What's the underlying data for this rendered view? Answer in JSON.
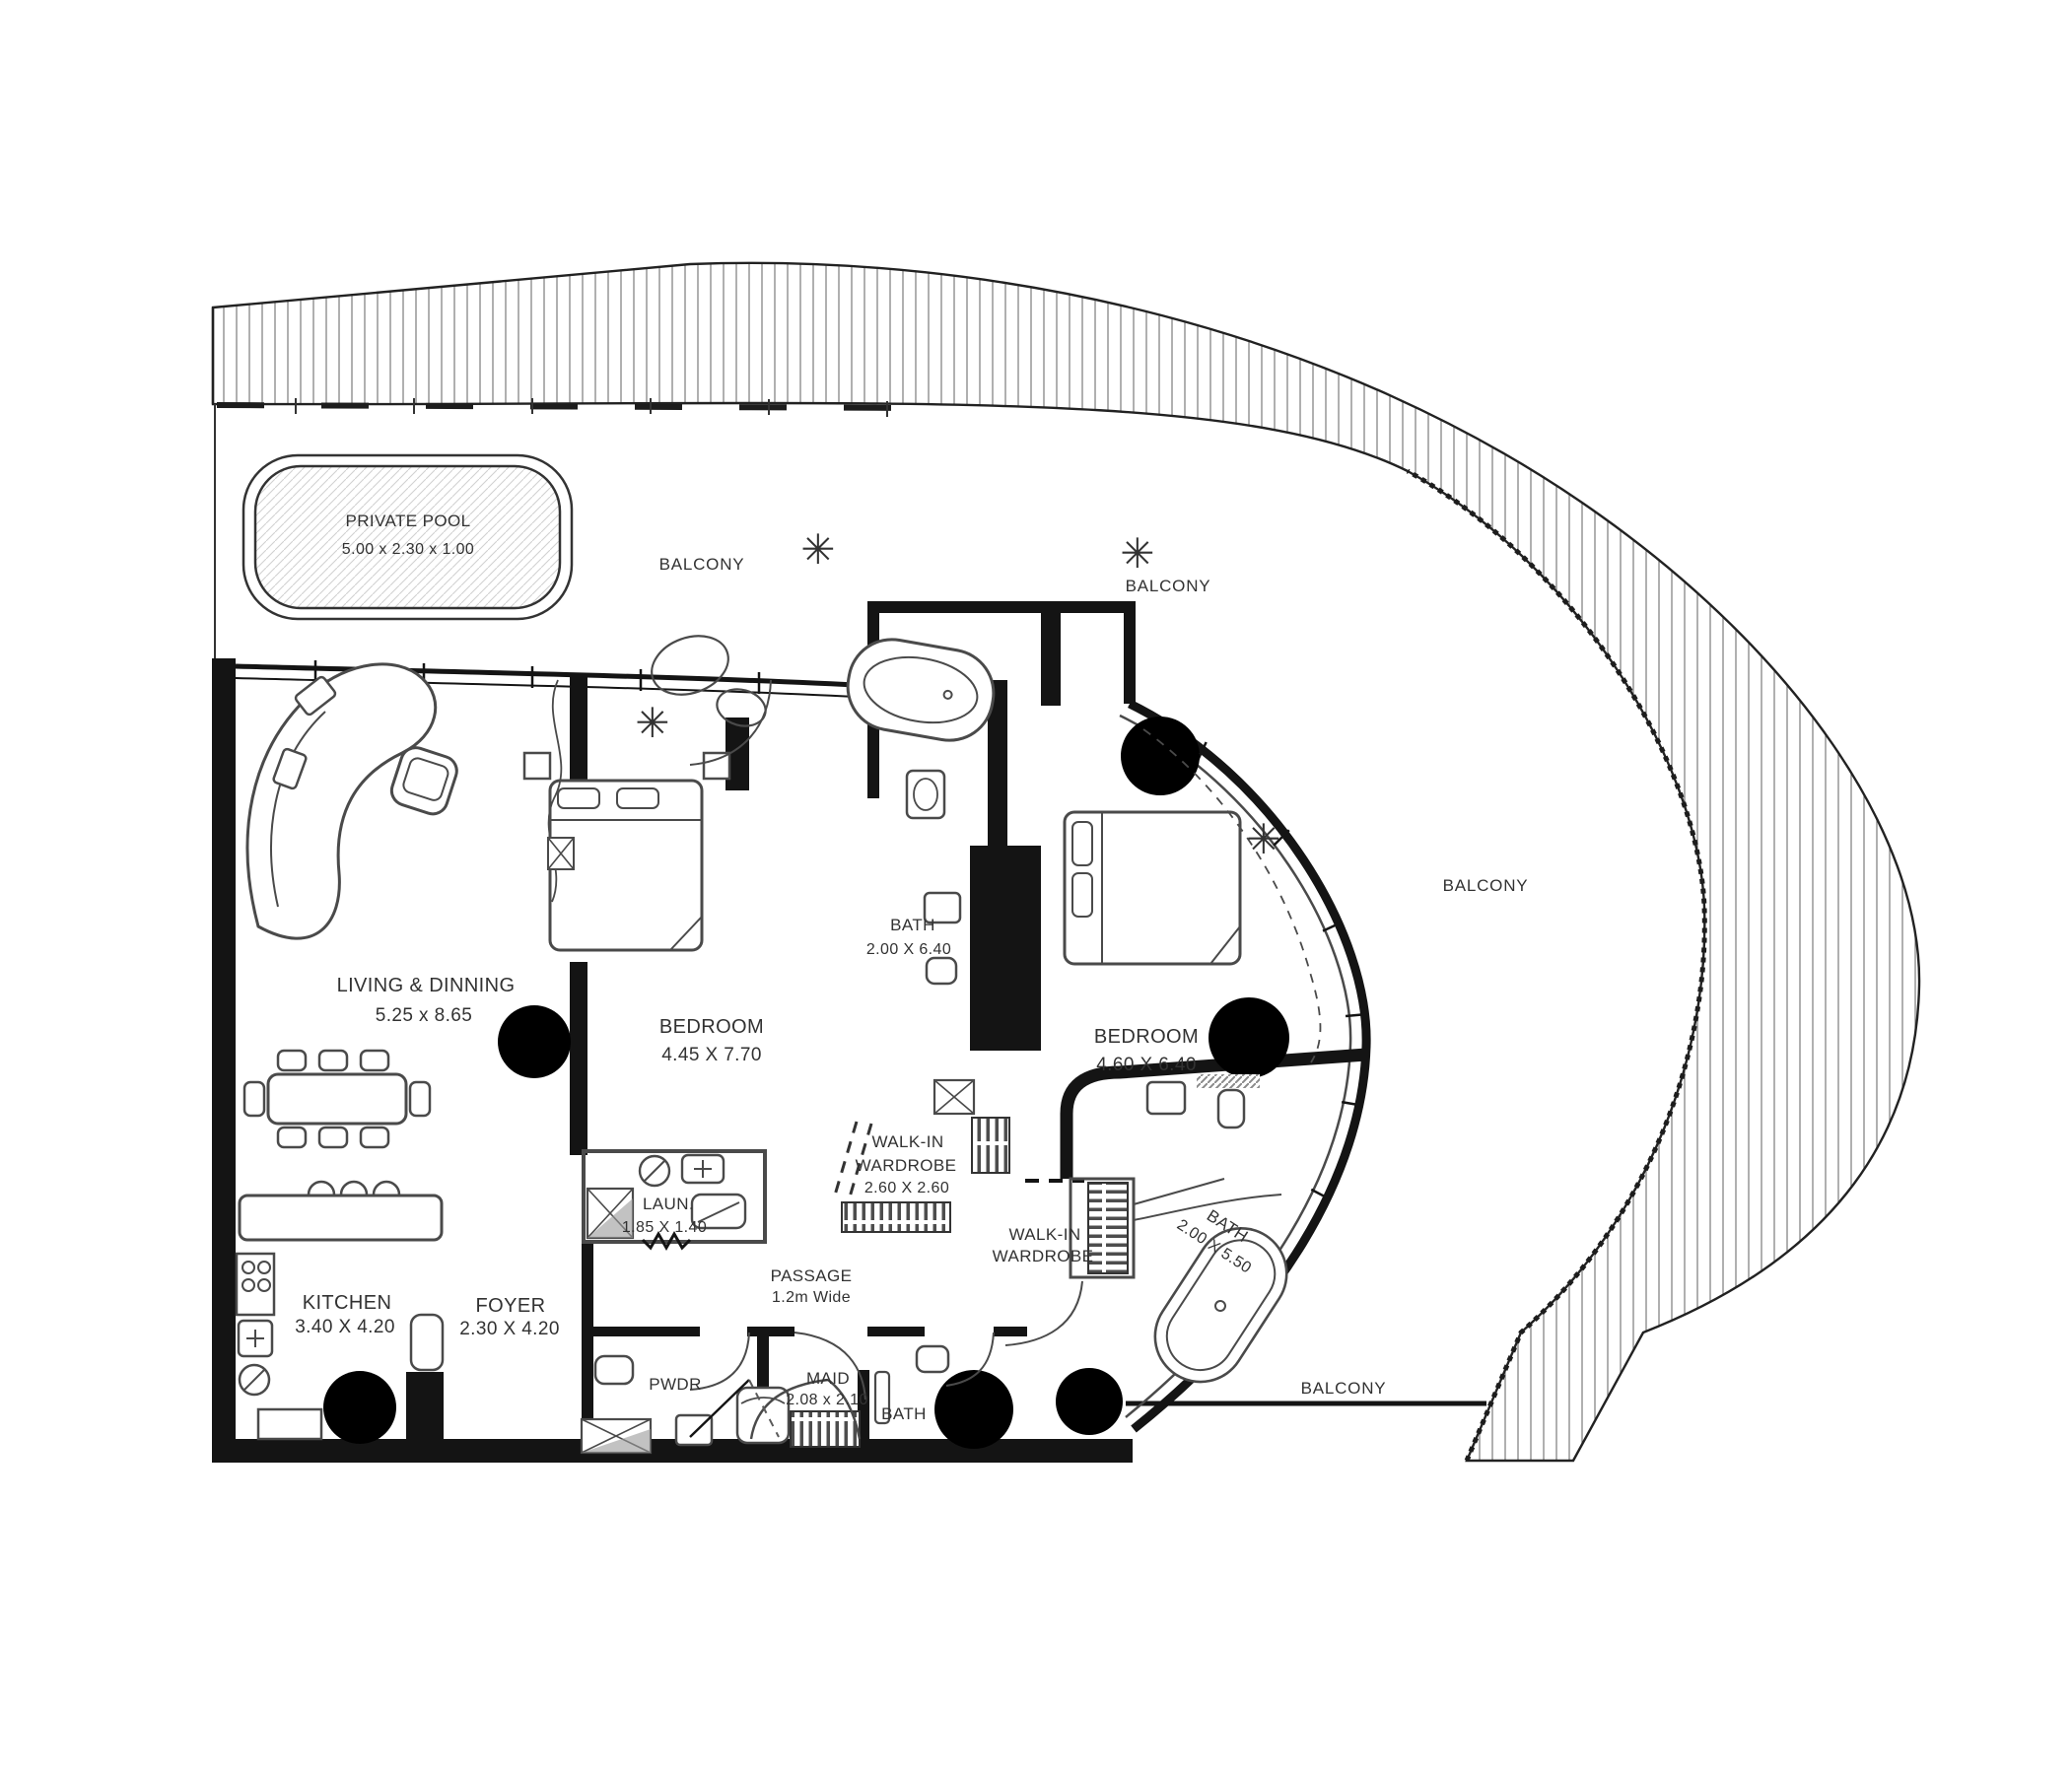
{
  "plan": {
    "pool": {
      "name": "PRIVATE POOL",
      "dims": "5.00 x 2.30 x 1.00"
    },
    "balconies": {
      "top_left": "BALCONY",
      "top_mid": "BALCONY",
      "right": "BALCONY",
      "bottom": "BALCONY"
    },
    "rooms": {
      "living": {
        "name": "LIVING & DINNING",
        "dims": "5.25 x 8.65"
      },
      "bedroom1": {
        "name": "BEDROOM",
        "dims": "4.45 X 7.70"
      },
      "bath1": {
        "name": "BATH",
        "dims": "2.00 X 6.40"
      },
      "bedroom2": {
        "name": "BEDROOM",
        "dims": "4.60 X 6.40"
      },
      "wardrobe1": {
        "name1": "WALK-IN",
        "name2": "WARDROBE",
        "dims": "2.60 X 2.60"
      },
      "wardrobe2": {
        "name1": "WALK-IN",
        "name2": "WARDROBE"
      },
      "laundry": {
        "name": "LAUN.",
        "dims": "1.85 X 1.40"
      },
      "passage": {
        "name": "PASSAGE",
        "dims": "1.2m Wide"
      },
      "kitchen": {
        "name": "KITCHEN",
        "dims": "3.40 X 4.20"
      },
      "foyer": {
        "name": "FOYER",
        "dims": "2.30 X 4.20"
      },
      "pwdr": {
        "name": "PWDR"
      },
      "maid": {
        "name": "MAID",
        "dims": "2.08 x 2.10"
      },
      "bath3": {
        "name": "BATH"
      },
      "bath2": {
        "name": "BATH",
        "dims": "2.00 X 5.50"
      }
    },
    "colors": {
      "wall": "#141414",
      "furniture_line": "#4a4a4a",
      "text": "#323232",
      "hatch_line": "#7a7a7a"
    }
  }
}
